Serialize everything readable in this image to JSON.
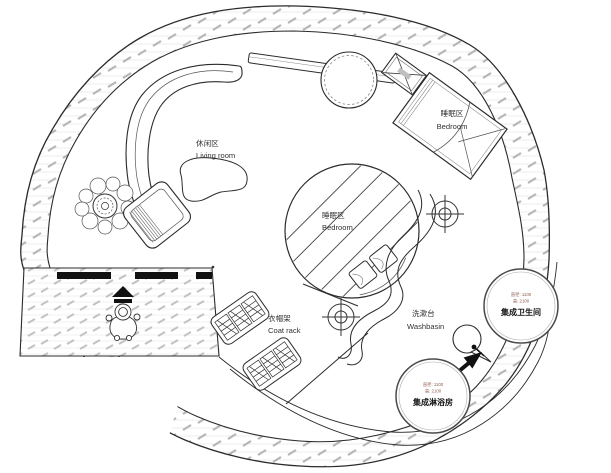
{
  "plan": {
    "living": {
      "zh": "休闲区",
      "en": "Living room"
    },
    "bedroom_upper": {
      "zh": "睡眠区",
      "en": "Bedroom"
    },
    "bedroom_center": {
      "zh": "睡眠区",
      "en": "Bedroom"
    },
    "coat_rack": {
      "zh": "衣帽架",
      "en": "Coat rack"
    },
    "washbasin": {
      "zh": "洗漱台",
      "en": "Washbasin"
    },
    "bathroom_pod": {
      "name": "集成卫生间",
      "dims": [
        "直径: 1100",
        "高: 2100"
      ]
    },
    "shower_pod": {
      "name": "集成淋浴房",
      "dims": [
        "直径: 1100",
        "高: 2100"
      ]
    },
    "colors": {
      "line": "#2b2b2b",
      "hatch": "#b5b5b5",
      "dim_text": "#8a5a4a"
    },
    "symbols": [
      "spiral-wall",
      "entrance-deck",
      "person-figure",
      "entry-arrow",
      "potted-plant",
      "lounge-chair",
      "curved-sofa",
      "coffee-table",
      "wall-shelf",
      "ac-unit",
      "round-table",
      "double-bed",
      "round-bed-platform",
      "bed-pillows",
      "target-marker",
      "sculpted-partition",
      "washbasin-bowl",
      "direction-arrow",
      "corridor-path",
      "coat-rack"
    ]
  }
}
